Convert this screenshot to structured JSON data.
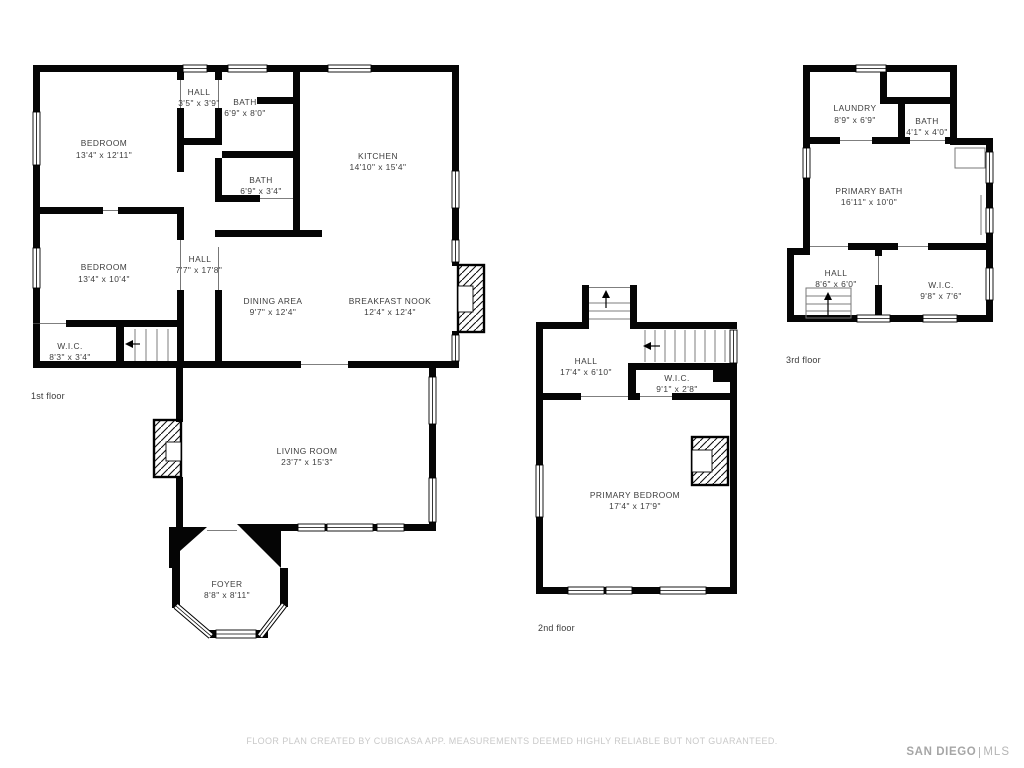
{
  "colors": {
    "wall": "#050505",
    "text": "#3d3d3d",
    "footer_text": "#c9c9c9",
    "logo_text": "#a6a6a6"
  },
  "floors": [
    {
      "label": "1st floor",
      "rooms": [
        {
          "name": "BEDROOM",
          "dims": "13'4\" x 12'11\""
        },
        {
          "name": "HALL",
          "dims": "3'5\" x 3'9\""
        },
        {
          "name": "BATH",
          "dims": "6'9\" x 8'0\""
        },
        {
          "name": "KITCHEN",
          "dims": "14'10\" x 15'4\""
        },
        {
          "name": "BATH",
          "dims": "6'9\" x 3'4\""
        },
        {
          "name": "BEDROOM",
          "dims": "13'4\" x 10'4\""
        },
        {
          "name": "HALL",
          "dims": "7'7\" x 17'8\""
        },
        {
          "name": "DINING AREA",
          "dims": "9'7\" x 12'4\""
        },
        {
          "name": "BREAKFAST NOOK",
          "dims": "12'4\" x 12'4\""
        },
        {
          "name": "W.I.C.",
          "dims": "8'3\" x 3'4\""
        },
        {
          "name": "LIVING ROOM",
          "dims": "23'7\" x 15'3\""
        },
        {
          "name": "FOYER",
          "dims": "8'8\" x 8'11\""
        }
      ]
    },
    {
      "label": "2nd floor",
      "rooms": [
        {
          "name": "HALL",
          "dims": "17'4\" x 6'10\""
        },
        {
          "name": "W.I.C.",
          "dims": "9'1\" x 2'8\""
        },
        {
          "name": "PRIMARY BEDROOM",
          "dims": "17'4\" x 17'9\""
        }
      ]
    },
    {
      "label": "3rd floor",
      "rooms": [
        {
          "name": "LAUNDRY",
          "dims": "8'9\" x 6'9\""
        },
        {
          "name": "BATH",
          "dims": "4'1\" x 4'0\""
        },
        {
          "name": "PRIMARY BATH",
          "dims": "16'11\" x 10'0\""
        },
        {
          "name": "HALL",
          "dims": "8'6\" x 6'0\""
        },
        {
          "name": "W.I.C.",
          "dims": "9'8\" x 7'6\""
        }
      ]
    }
  ],
  "footer": {
    "disclaimer": "FLOOR PLAN CREATED BY CUBICASA APP. MEASUREMENTS DEEMED HIGHLY RELIABLE BUT NOT GUARANTEED.",
    "logo": {
      "brand": "SAN DIEGO",
      "suffix": "MLS"
    }
  }
}
